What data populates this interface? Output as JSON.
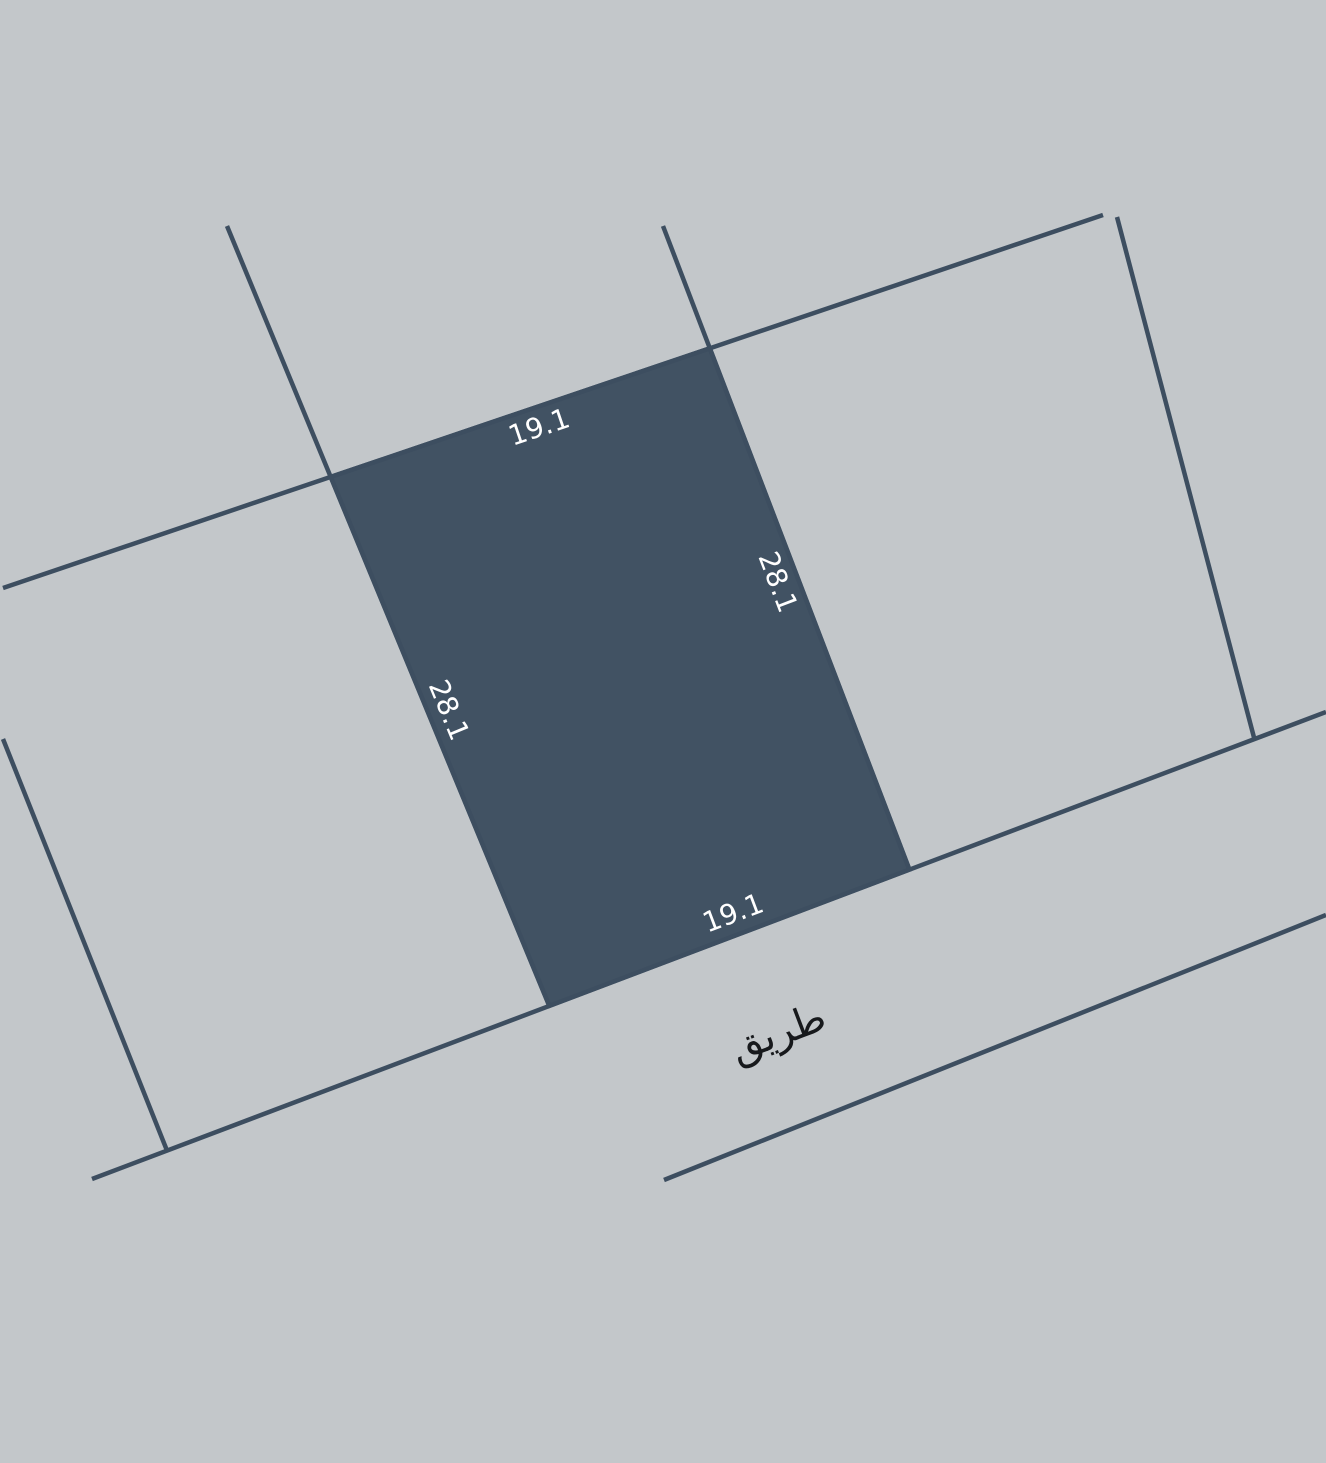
{
  "canvas": {
    "width": 1326,
    "height": 1463,
    "background_color": "#c3c7ca"
  },
  "palette": {
    "parcel_fill": "#415263",
    "boundary_line": "#3d4e60",
    "dimension_text_color": "#ffffff",
    "road_text_color": "#17191c"
  },
  "parcel": {
    "id": "highlighted-parcel",
    "polygon_points": [
      [
        330.7,
        476.9
      ],
      [
        709.8,
        348.3
      ],
      [
        909.4,
        869.6
      ],
      [
        549.3,
        1005.9
      ]
    ],
    "dimensions": [
      {
        "edge": "top",
        "label": "19.1",
        "x": 539,
        "y": 427,
        "rotation_deg": -18.7,
        "font_size": 28
      },
      {
        "edge": "right",
        "label": "28.1",
        "x": 778,
        "y": 582,
        "rotation_deg": 69,
        "font_size": 28
      },
      {
        "edge": "left",
        "label": "28.1",
        "x": 449,
        "y": 710,
        "rotation_deg": 67.5,
        "font_size": 28
      },
      {
        "edge": "bottom",
        "label": "19.1",
        "x": 733,
        "y": 913,
        "rotation_deg": -20.7,
        "font_size": 28
      }
    ]
  },
  "boundary_lines": [
    {
      "name": "block-upper-boundary",
      "x1": 3,
      "y1": 588,
      "x2": 1103,
      "y2": 215
    },
    {
      "name": "parcel-left-side-boundary",
      "x1": 227,
      "y1": 226,
      "x2": 549.3,
      "y2": 1005.9
    },
    {
      "name": "parcel-right-side-boundary",
      "x1": 663,
      "y1": 226,
      "x2": 909.4,
      "y2": 869.6
    },
    {
      "name": "east-neighbor-boundary",
      "x1": 1117,
      "y1": 217,
      "x2": 1254.4,
      "y2": 739
    },
    {
      "name": "west-neighbor-boundary",
      "x1": 3,
      "y1": 739,
      "x2": 167,
      "y2": 1150.6
    },
    {
      "name": "road-upper-edge",
      "x1": 92,
      "y1": 1179,
      "x2": 1326,
      "y2": 712
    },
    {
      "name": "road-lower-edge",
      "x1": 664,
      "y1": 1180,
      "x2": 1326,
      "y2": 915
    }
  ],
  "line_stroke_width": 4.5,
  "road": {
    "label": "طريق",
    "x": 778,
    "y": 1033,
    "rotation_deg": -20.7,
    "font_size": 40
  }
}
